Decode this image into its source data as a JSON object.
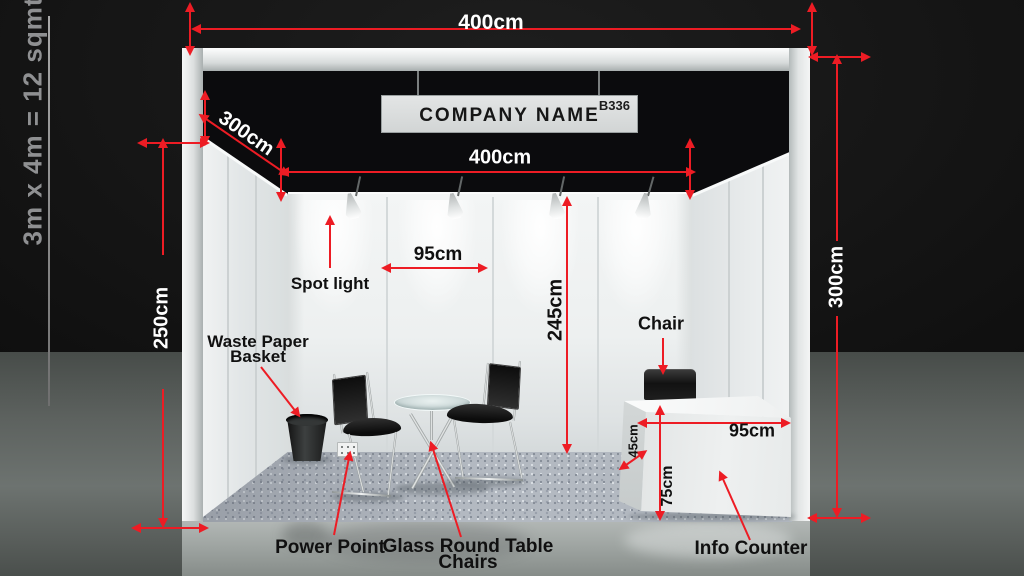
{
  "side_note": "3m x 4m = 12 sqmt",
  "sign": {
    "company": "COMPANY NAME",
    "booth_no": "B336"
  },
  "dims": {
    "top_width": "400cm",
    "left_depth": "300cm",
    "inner_width": "400cm",
    "left_height": "250cm",
    "spot_spacing": "95cm",
    "wall_height": "245cm",
    "right_height": "300cm",
    "counter_width": "95cm",
    "counter_depth": "45cm",
    "counter_height": "75cm"
  },
  "labels": {
    "spot_light": "Spot light",
    "waste_basket": [
      "Waste Paper",
      "Basket"
    ],
    "chair": "Chair",
    "power_point": "Power Point",
    "glass_table": [
      "Glass Round Table",
      "Chairs"
    ],
    "info_counter": "Info Counter"
  },
  "colors": {
    "dimension_red": "#ed1c24",
    "fascia_black": "#0b0b0d",
    "wall_white": "#eef0f0",
    "carpet_gray": "#b3b9c1"
  }
}
